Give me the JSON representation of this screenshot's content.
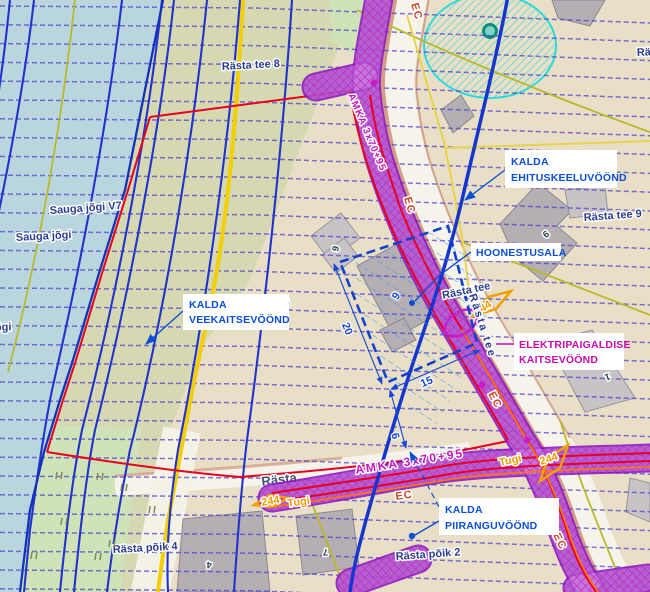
{
  "zones": {
    "kalda": "KALDA",
    "ehituskeeluvoond": "EHITUSKEELUVÖÖND",
    "hoonestusala": "HOONESTUSALA",
    "veekaitsevoond": "VEEKAITSEVÖÖND",
    "elektripaigaldise": "ELEKTRIPAIGALDISE",
    "kaitsevoond": "KAITSEVÖÖND",
    "piiranguvoond": "PIIRANGUVÖÖND"
  },
  "streets": {
    "rasta_tee_8": "Rästa tee 8",
    "rasta_tee_9": "Rästa tee 9",
    "rasta_tee_6": "Rästa tee 6",
    "rasta_tee": "Rästa tee",
    "rasta_short": "Rästa",
    "rasta_clipped": "Rä",
    "rasta_poik_4": "Rästa põik 4",
    "rasta_poik_2": "Rästa põik 2"
  },
  "water": {
    "sauga_jogi": "Sauga jõgi",
    "sauga_jogi_v": "Sauga jõgi V7",
    "jogi_clipped": "jõgi"
  },
  "powerline": {
    "cable_label": "AMKA 3x70+95",
    "ec_label": "EC",
    "pole_number": "244",
    "pole_type": "Tugi"
  },
  "dimensions": {
    "left": "20",
    "bottom": "15",
    "gap": "6",
    "area_number": "9"
  },
  "house_numbers": {
    "rasta9_main": "9",
    "plot9_small": "9",
    "house1": "1",
    "house4": "4",
    "house7": "7"
  },
  "colors": {
    "water": "#b9d6df",
    "land_khaki": "#d6d8b2",
    "land_beige": "#e9dec6",
    "grass": "#cfe2b8",
    "road": "#f6f3ea",
    "road_edge": "#c9886e",
    "boundary_red": "#e8001e",
    "cadastral_yellow": "#f2cf00",
    "drainage_blue": "#4b43cf",
    "contour_blue": "#2233cc",
    "powerline_magenta": "#c41ec4",
    "protection_cyan": "#2adbdb",
    "label_blue": "#0a4fd7",
    "label_magenta": "#cc0ab4",
    "pole_orange": "#f59a00"
  }
}
